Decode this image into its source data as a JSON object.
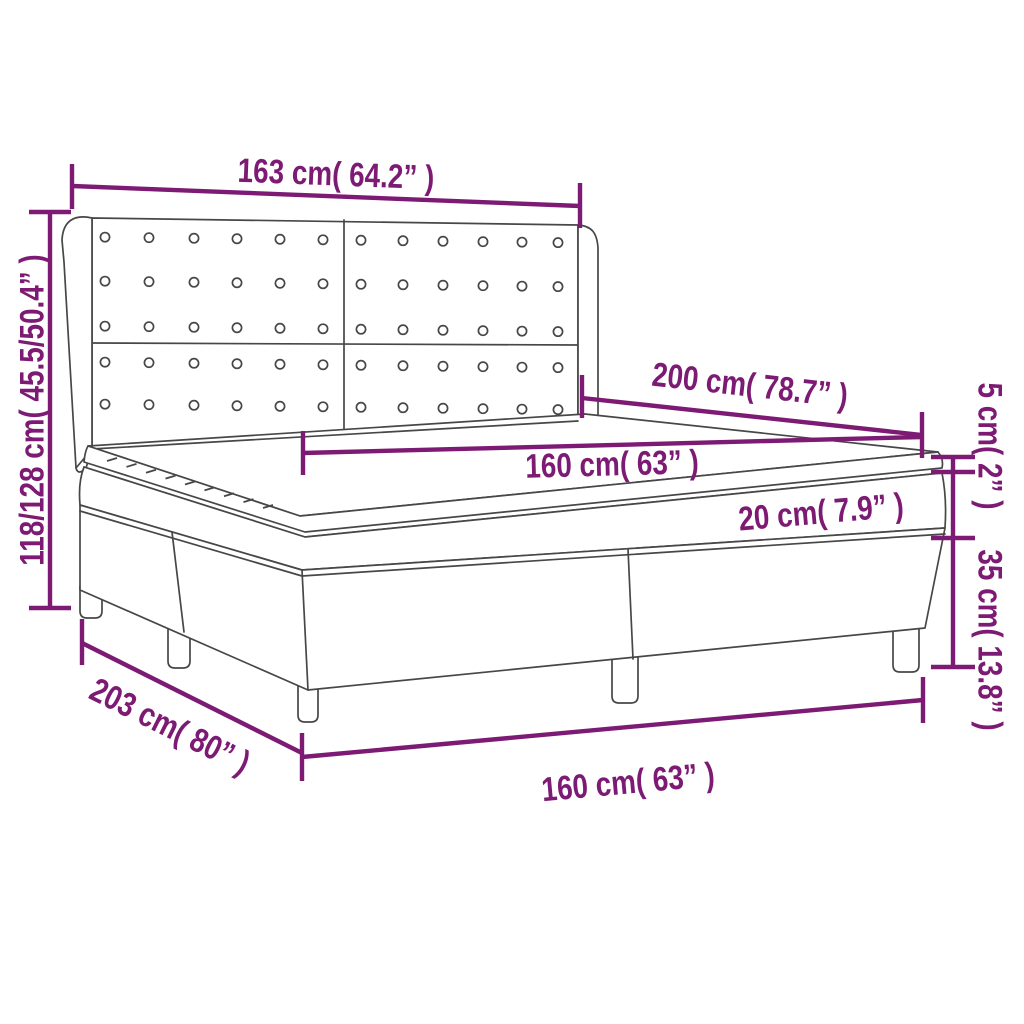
{
  "diagram": {
    "title": "Box spring bed with headboard - dimension drawing",
    "accent_color": "#7C1A74",
    "line_color": "#474747",
    "labels": {
      "headboard_width": "163 cm( 64.2” )",
      "bed_height": "118/128 cm( 45.5/50.4” )",
      "mattress_length": "200 cm( 78.7” )",
      "mattress_width_top": "160 cm( 63” )",
      "topper_thickness": "5 cm( 2” )",
      "base_height": "35 cm( 13.8” )",
      "mattress_thickness": "20 cm( 7.9” )",
      "base_length": "203 cm( 80” )",
      "base_width_bottom": "160 cm( 63” )"
    }
  }
}
